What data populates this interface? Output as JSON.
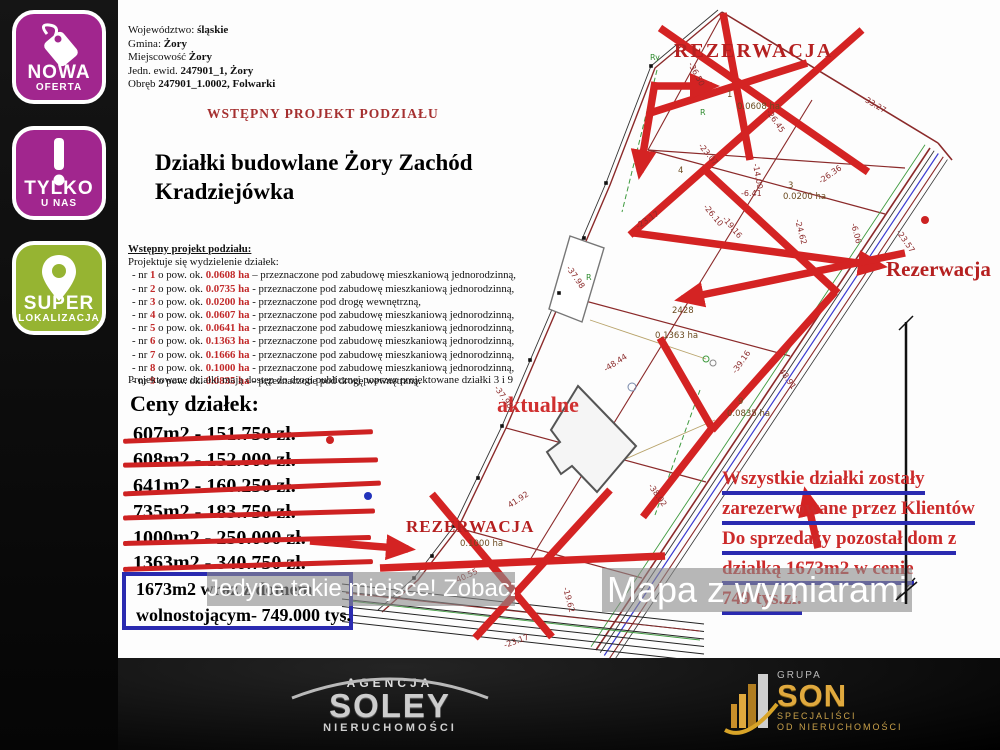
{
  "badges": [
    {
      "line1": "NOWA",
      "line2": "OFERTA",
      "color": "#a1268e",
      "icon": "price-tag-icon"
    },
    {
      "line1": "TYLKO",
      "line2": "U NAS",
      "color": "#a1268e",
      "icon": "exclamation-icon"
    },
    {
      "line1": "SUPER",
      "line2": "LOKALIZACJA",
      "color": "#96b432",
      "icon": "location-pin-icon"
    }
  ],
  "header": {
    "lines": [
      {
        "label": "Województwo:",
        "value": "śląskie"
      },
      {
        "label": "Gmina:",
        "value": "Żory"
      },
      {
        "label": "Miejscowość",
        "value": "Żory"
      },
      {
        "label": "Jedn. ewid.",
        "value": "247901_1, Żory"
      },
      {
        "label": "Obręb",
        "value": "247901_1.0002, Folwarki"
      }
    ],
    "project_heading": "WSTĘPNY PROJEKT PODZIAŁU",
    "title_line1": "Działki budowlane Żory Zachód",
    "title_line2": "Kradziejówka"
  },
  "podzial": {
    "heading": "Wstępny projekt podziału:",
    "intro": "Projektuje się wydzielenie działek:",
    "prefix": "-  nr",
    "mid": "o pow. ok.",
    "items": [
      {
        "nr": "1",
        "area": "0.0608 ha",
        "sep": "–",
        "use": "przeznaczone pod zabudowę mieszkaniową jednorodzinną,"
      },
      {
        "nr": "2",
        "area": "0.0735 ha",
        "sep": "-",
        "use": "przeznaczone pod zabudowę mieszkaniową jednorodzinną,"
      },
      {
        "nr": "3",
        "area": "0.0200 ha",
        "sep": "-",
        "use": "przeznaczone pod drogę wewnętrzną,"
      },
      {
        "nr": "4",
        "area": "0.0607 ha",
        "sep": "-",
        "use": "przeznaczone pod zabudowę mieszkaniową jednorodzinną,"
      },
      {
        "nr": "5",
        "area": "0.0641 ha",
        "sep": "-",
        "use": "przeznaczone pod zabudowę mieszkaniową jednorodzinną,"
      },
      {
        "nr": "6",
        "area": "0.1363 ha",
        "sep": "-",
        "use": "przeznaczone pod zabudowę mieszkaniową jednorodzinną,"
      },
      {
        "nr": "7",
        "area": "0.1666 ha",
        "sep": "-",
        "use": "przeznaczone pod zabudowę mieszkaniową jednorodzinną,"
      },
      {
        "nr": "8",
        "area": "0.1000 ha",
        "sep": "-",
        "use": "przeznaczone pod zabudowę mieszkaniową jednorodzinną,"
      },
      {
        "nr": "9",
        "area": "0.0835 ha",
        "sep": "-",
        "use": "przeznaczone pod drogę wewnętrzną."
      }
    ],
    "footnote": "Projektowane działki mają dostęp do drogi publicznej poprzez projektowane działki 3 i 9"
  },
  "prices": {
    "heading": "Ceny działek:",
    "struck_items": [
      "607m2 - 151.750 zł.",
      "608m2 - 152.000 zł.",
      "641m2 - 160.250 zł.",
      "735m2 - 183.750 zł.",
      "1000m2 - 250.000 zł.",
      "1363m2 - 340.750 zł."
    ],
    "house_offer": {
      "line1": "1673m2 wraz z domem",
      "line2": "wolnostojącym- 749.000 tys."
    }
  },
  "reservation_note": {
    "lines": [
      "Wszystkie działki zostały",
      "zarezerwowane przez Klientów",
      "Do sprzedaży pozostał dom z",
      "działką 1673m2 w cenie",
      "749 tys.zł."
    ]
  },
  "watermarks": {
    "left": "Jedyne takie miejsce! Zobacz!",
    "right": "Mapa z wymiarami"
  },
  "map": {
    "labels": {
      "rezerwacja_top": "REZERWACJA",
      "rezerwacja_right": "Rezerwacja",
      "aktualne": "aktualne",
      "rezerwacja_bottom": "REZERWACJA"
    },
    "plot_labels": [
      {
        "text": "1",
        "x": 727,
        "y": 97
      },
      {
        "text": "0.0608 ha",
        "x": 737,
        "y": 109
      },
      {
        "text": "4",
        "x": 678,
        "y": 173
      },
      {
        "text": "3",
        "x": 788,
        "y": 188
      },
      {
        "text": "0.0200 ha",
        "x": 783,
        "y": 199
      },
      {
        "text": "2428",
        "x": 672,
        "y": 313
      },
      {
        "text": "0.1363 ha",
        "x": 655,
        "y": 338
      },
      {
        "text": "9",
        "x": 738,
        "y": 404
      },
      {
        "text": "0.0835 ha",
        "x": 727,
        "y": 416
      },
      {
        "text": "0.1000 ha",
        "x": 460,
        "y": 546
      }
    ],
    "dimension_labels": [
      {
        "text": "-36.50",
        "x": 688,
        "y": 64,
        "r": 62
      },
      {
        "text": "-33.27",
        "x": 862,
        "y": 100,
        "r": 31
      },
      {
        "text": "-23.07",
        "x": 698,
        "y": 146,
        "r": 50
      },
      {
        "text": "-26.45",
        "x": 766,
        "y": 112,
        "r": 55
      },
      {
        "text": "-14.00",
        "x": 753,
        "y": 164,
        "r": 80
      },
      {
        "text": "-6.41",
        "x": 741,
        "y": 196,
        "r": 0
      },
      {
        "text": "-26.10",
        "x": 703,
        "y": 207,
        "r": 50
      },
      {
        "text": "-19.16",
        "x": 722,
        "y": 219,
        "r": 50
      },
      {
        "text": "-26.36",
        "x": 821,
        "y": 184,
        "r": -35
      },
      {
        "text": "-24.62",
        "x": 795,
        "y": 220,
        "r": 75
      },
      {
        "text": "-6.06",
        "x": 851,
        "y": 224,
        "r": 75
      },
      {
        "text": "-23.57",
        "x": 896,
        "y": 232,
        "r": 55
      },
      {
        "text": "-23.17",
        "x": 638,
        "y": 229,
        "r": -33
      },
      {
        "text": "-37.98",
        "x": 566,
        "y": 268,
        "r": 55
      },
      {
        "text": "48.91",
        "x": 779,
        "y": 371,
        "r": 55
      },
      {
        "text": "-48.44",
        "x": 606,
        "y": 372,
        "r": -33
      },
      {
        "text": "-39.16",
        "x": 736,
        "y": 374,
        "r": -55
      },
      {
        "text": "-37.98",
        "x": 494,
        "y": 388,
        "r": 55
      },
      {
        "text": "-38.02",
        "x": 648,
        "y": 486,
        "r": 55
      },
      {
        "text": "41.92",
        "x": 510,
        "y": 508,
        "r": -33
      },
      {
        "text": "-40.55",
        "x": 455,
        "y": 584,
        "r": -25
      },
      {
        "text": "-19.62",
        "x": 563,
        "y": 588,
        "r": 75
      },
      {
        "text": "-23.17",
        "x": 505,
        "y": 648,
        "r": -20
      }
    ],
    "survey_marks": [
      "Ry",
      "R",
      "R"
    ]
  },
  "footer": {
    "soley": {
      "top": "AGENCJA",
      "name": "SOLEY",
      "bottom": "NIERUCHOMOŚCI"
    },
    "son": {
      "group": "GRUPA",
      "name": "SON",
      "line1": "SPECJALIŚCI",
      "line2": "OD NIERUCHOMOŚCI"
    }
  },
  "colors": {
    "badge_magenta": "#a1268e",
    "badge_green": "#96b432",
    "thick_red": "#d42323",
    "dark_red_text": "#b52020",
    "blue_accent": "#2a2ab0",
    "map_line": "#8b2a2a"
  }
}
